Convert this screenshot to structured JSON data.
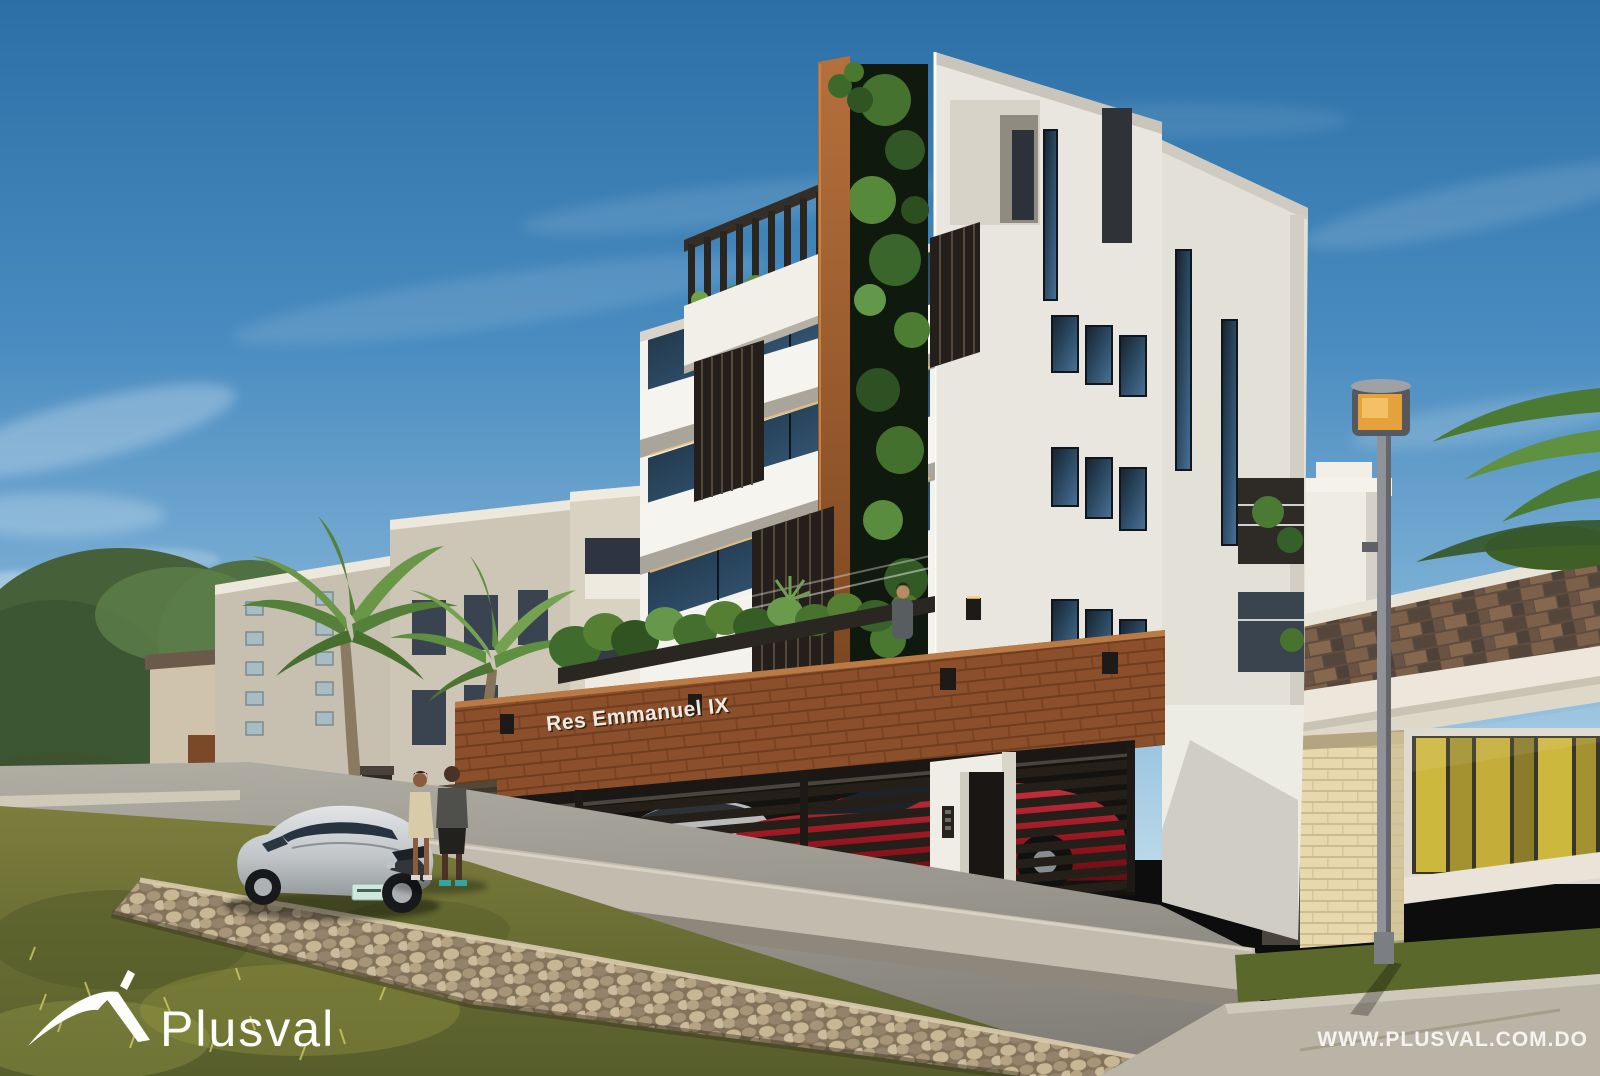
{
  "image": {
    "type": "architectural-exterior-render",
    "scene": "street view of a modern multi-storey residential project on a sunny day"
  },
  "branding": {
    "logo_text": "Plusval",
    "website_url": "WWW.PLUSVAL.COM.DO"
  },
  "building_sign": {
    "text": "Res Emmanuel IX"
  },
  "palette": {
    "sky_top": "#2b6fa6",
    "sky_horizon": "#b9d8e9",
    "facade_white": "#f4f2ec",
    "corten_brown": "#985a2d",
    "brick_band": "#8c4f2b",
    "slat_dark": "#242019",
    "vine_green": "#4a7a33",
    "street_gray": "#9a978e",
    "grass_olive": "#6e7034",
    "stone_wall_tan": "#b5a383",
    "lamp_amber": "#e5a23c",
    "roof_shingle": "#6b5344",
    "curtain_yellow": "#c9b544",
    "red_car": "#95141f",
    "silver_car": "#c2c6c9"
  },
  "scene_objects": [
    {
      "name": "main-building",
      "label": "white modern residential building with corten fin, vertical garden, slat screens and rooftop pergola"
    },
    {
      "name": "brick-signage-band",
      "label": "corten brick band with project sign and sconce lights"
    },
    {
      "name": "parking-gate",
      "label": "dark horizontal-slat gate with red and silver cars behind"
    },
    {
      "name": "entrance-door",
      "label": "pedestrian entrance with intercom panel"
    },
    {
      "name": "neighbor-building-left",
      "label": "beige three-storey apartment building with balconies"
    },
    {
      "name": "neighbor-house-right",
      "label": "single-storey house with brown shingle roof and yellow curtains"
    },
    {
      "name": "street-lamp",
      "label": "gray pole street lamp with amber head"
    },
    {
      "name": "parked-car",
      "label": "silver coupe parked on the street"
    },
    {
      "name": "pedestrians",
      "label": "two people talking on the sidewalk"
    },
    {
      "name": "terrace-person",
      "label": "man standing on the landscaped first-floor terrace"
    },
    {
      "name": "palm-trees",
      "label": "palms and tropical vegetation"
    },
    {
      "name": "stone-wall",
      "label": "stacked stone retaining wall along the grass verge"
    }
  ]
}
